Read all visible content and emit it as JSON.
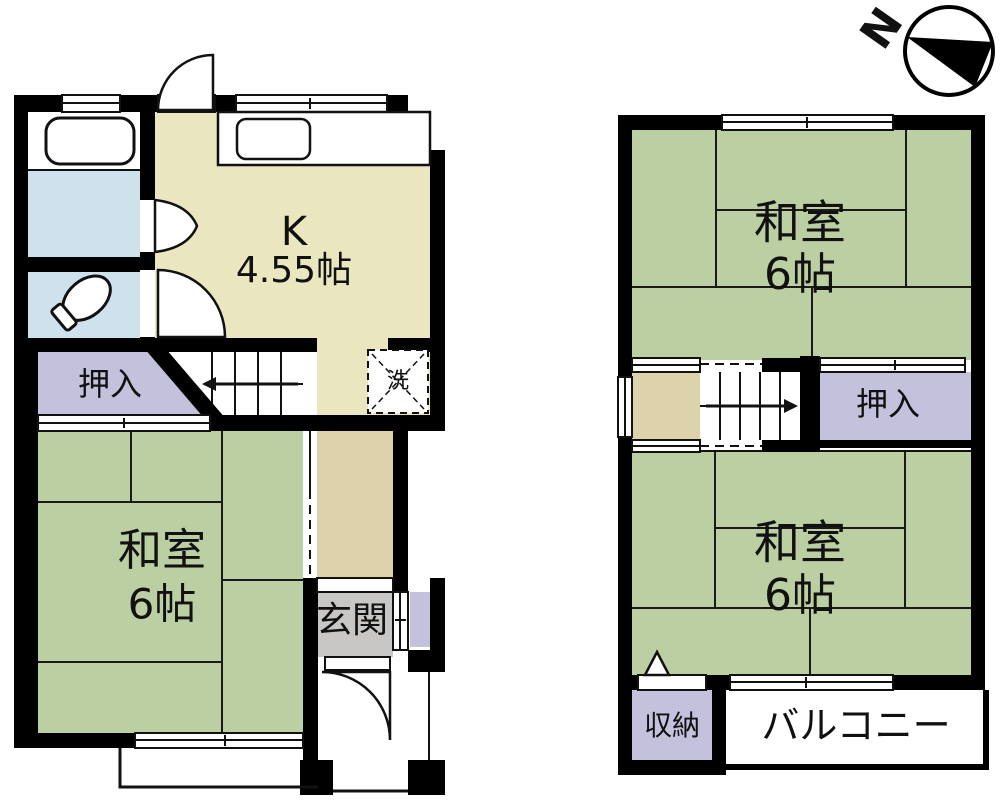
{
  "compass": {
    "north_label": "N"
  },
  "colors": {
    "tatami_green": "#bccfa2",
    "kitchen_yellow": "#e9e6c0",
    "closet_lavender": "#c3c1dc",
    "bath_blue": "#cfe1ec",
    "hall_tan": "#ded2ac",
    "genkan_gray": "#c8c7c5",
    "wall_black": "#000000",
    "fixture_white": "#ffffff"
  },
  "floor1": {
    "kitchen": {
      "label": "K",
      "size": "4.55帖"
    },
    "washitsu": {
      "label": "和室",
      "size": "6帖"
    },
    "oshiire": {
      "label": "押入"
    },
    "genkan": {
      "label": "玄関"
    },
    "laundry": {
      "label": "洗"
    }
  },
  "floor2": {
    "washitsu_top": {
      "label": "和室",
      "size": "6帖"
    },
    "washitsu_bottom": {
      "label": "和室",
      "size": "6帖"
    },
    "oshiire": {
      "label": "押入"
    },
    "storage": {
      "label": "収納"
    },
    "balcony": {
      "label": "バルコニー"
    }
  }
}
